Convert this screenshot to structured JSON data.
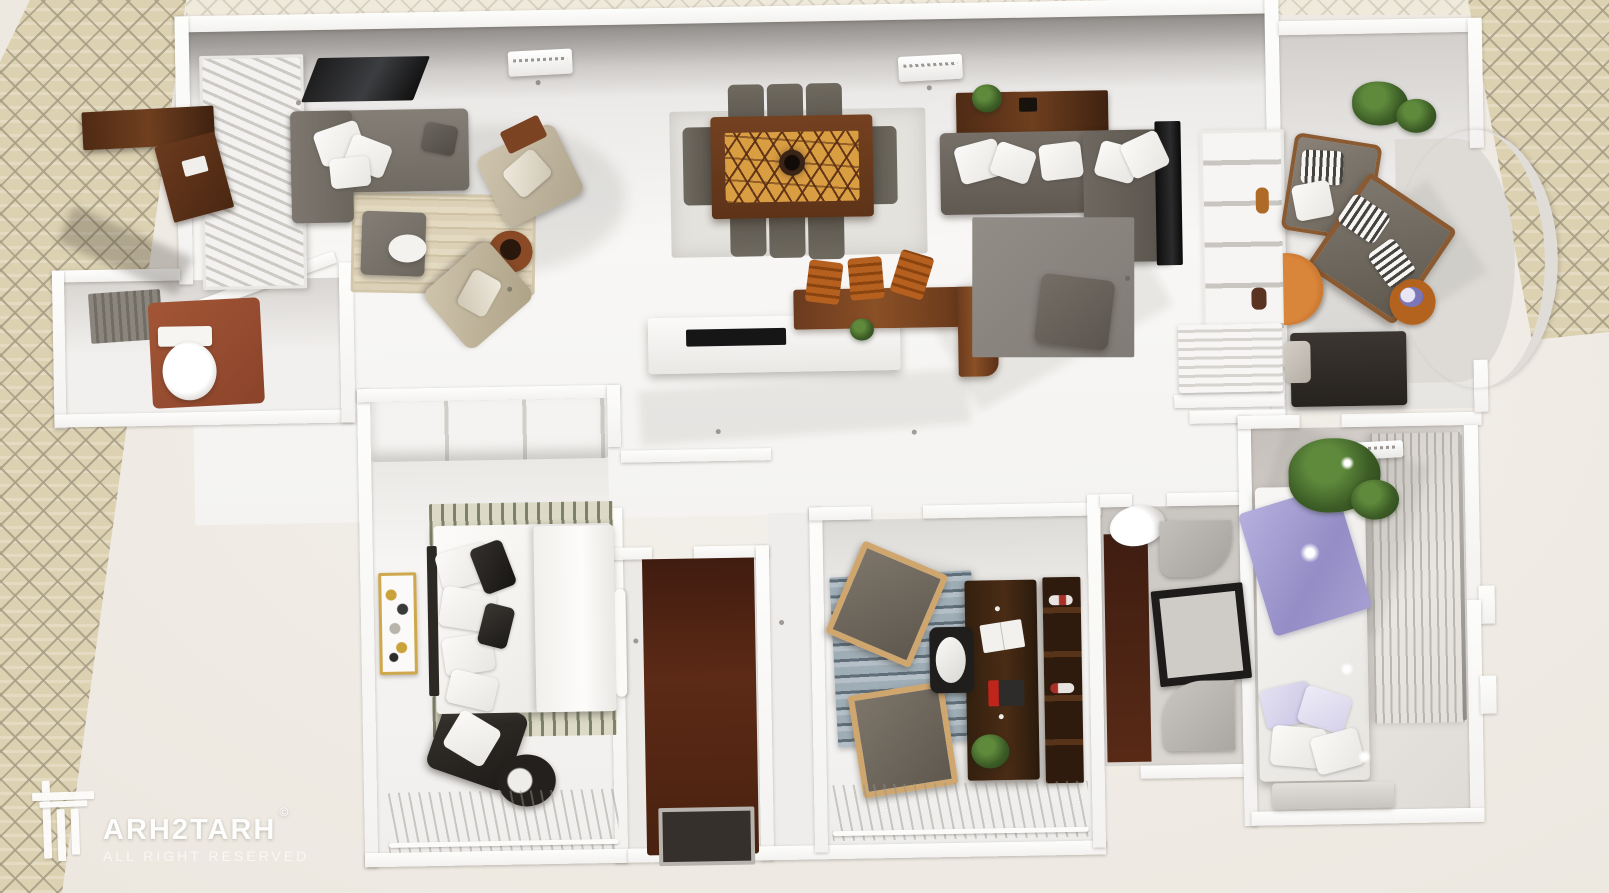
{
  "watermark": {
    "brand": "ARH2TARH",
    "copyright_symbol": "©",
    "tagline": "ALL RIGHT RESERVED"
  },
  "scene": {
    "type": "3d-top-down-apartment-floor-plan-render",
    "rooms": [
      {
        "name": "living-room",
        "furniture": [
          "gray-sectional-sofa",
          "wall-tv",
          "striped-beige-rug",
          "gray-ottoman",
          "beige-armchair-1",
          "beige-armchair-2",
          "white-side-table",
          "wood-coffee-table",
          "window-shutters"
        ]
      },
      {
        "name": "dining-area",
        "furniture": [
          "wood-dining-table-mosaic-top",
          "gray-dining-chairs-x8",
          "pendant-light",
          "light-rug"
        ]
      },
      {
        "name": "kitchen",
        "furniture": [
          "white-island-with-cooktop",
          "l-shaped-wood-bar-counter",
          "orange-bar-stools-x3",
          "small-plant"
        ]
      },
      {
        "name": "family-room",
        "furniture": [
          "taupe-sectional-sofa",
          "wood-media-console",
          "dark-gray-rug",
          "ottoman",
          "wall-tv",
          "white-shelving-unit",
          "louver-panel",
          "plant"
        ]
      },
      {
        "name": "sitting-room",
        "furniture": [
          "armchair-striped-cushion-1",
          "armchair-striped-cushion-2",
          "half-round-wood-table",
          "round-side-table-flowers",
          "dark-sofa",
          "tall-plant",
          "curved-bay-wall"
        ]
      },
      {
        "name": "powder-room",
        "furniture": [
          "toilet",
          "shower",
          "terracotta-floor"
        ]
      },
      {
        "name": "master-bedroom",
        "furniture": [
          "double-bed-white-bedding",
          "black-accent-pillows",
          "patterned-runners",
          "wardrobe-cabinets",
          "wall-art-frame",
          "dark-armchair-throw",
          "round-black-side-table",
          "sheer-curtains"
        ]
      },
      {
        "name": "entry-hall",
        "furniture": [
          "dark-wood-floor",
          "framed-doormat",
          "interior-door"
        ]
      },
      {
        "name": "home-office",
        "furniture": [
          "dark-wood-desk",
          "open-book",
          "office-chair",
          "wood-frame-armchair-1",
          "wood-frame-armchair-2",
          "blue-striped-rug",
          "dark-bookshelf",
          "plant",
          "sheer-curtains"
        ]
      },
      {
        "name": "bathroom",
        "furniture": [
          "toilet",
          "vanity-sink",
          "black-frame-mirror",
          "dark-wood-floor-strip"
        ]
      },
      {
        "name": "second-bedroom",
        "furniture": [
          "double-bed-lavender-bedding",
          "large-green-plant",
          "sheer-curtain-wall",
          "bench",
          "ac-unit"
        ]
      }
    ],
    "exterior": [
      "herringbone-brick-paving-left",
      "herringbone-brick-paving-top-right",
      "outdoor-wood-counter"
    ]
  },
  "palette": {
    "background": "#f1ede7",
    "brick": "#dcd1b1",
    "brick_grout": "#a89e86",
    "wall": "#fbfafa",
    "floor": "#f4f2f0",
    "sofa_gray": "#7b756d",
    "sofa_taupe": "#6e675f",
    "wood_dark": "#5a3018",
    "wood_amber": "#d99d42",
    "stool_orange": "#b5601f",
    "terracotta": "#9c4f30",
    "entry_floor": "#53281a",
    "rug_blue_gray": "#a9b6bf",
    "lavender": "#aaa4d8",
    "plant_green": "#3c5527"
  }
}
